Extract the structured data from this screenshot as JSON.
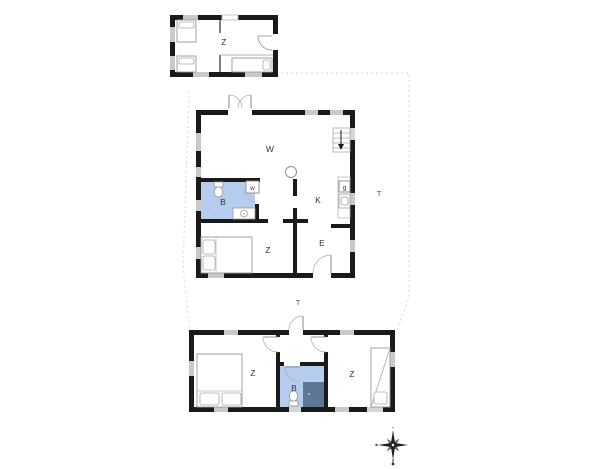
{
  "buildings": {
    "annex": {
      "rooms": {
        "bedroom": "Z"
      }
    },
    "main_house": {
      "rooms": {
        "living": "W",
        "bathroom": "B",
        "kitchen": "K",
        "bedroom": "Z",
        "entrance": "E"
      },
      "appliances": {
        "washing_machine": "w",
        "stove": "g"
      }
    },
    "outbuilding": {
      "rooms": {
        "bedroom_left": "Z",
        "bathroom": "B",
        "bedroom_right": "Z"
      }
    }
  },
  "outdoor": {
    "terrace_east": "T",
    "terrace_center": "T"
  },
  "colors": {
    "wall": "#1a1a1a",
    "bathroom_fill": "#b7cdef",
    "shower_dark": "#5e7795",
    "window": "#c9c9c9",
    "fixture_outline": "#999999",
    "plot_boundary": "#dedede",
    "label": "#333333"
  }
}
